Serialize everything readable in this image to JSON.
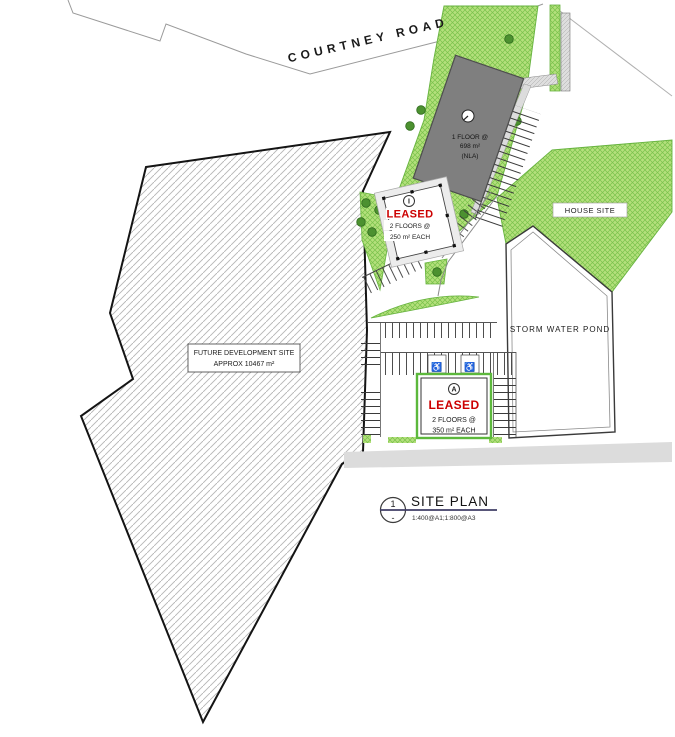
{
  "road": {
    "name": "COURTNEY ROAD"
  },
  "main_building": {
    "floors": "1 FLOOR @",
    "area": "698 m²",
    "nla": "(NLA)"
  },
  "leased_unit_i": {
    "marker": "I",
    "status": "LEASED",
    "floors": "2 FLOORS @",
    "area": "250 m² EACH"
  },
  "leased_unit_a": {
    "marker": "A",
    "status": "LEASED",
    "floors": "2 FLOORS @",
    "area": "350 m² EACH"
  },
  "house_site": {
    "label": "HOUSE SITE"
  },
  "storm_water_pond": {
    "label": "STORM WATER POND"
  },
  "future_development": {
    "line1": "FUTURE DEVELOPMENT SITE",
    "line2": "APPROX 10467 m²"
  },
  "title_block": {
    "detail_number": "1",
    "detail_sub": "-",
    "title": "SITE PLAN",
    "scale": "1:400@A1;1:800@A3"
  },
  "symbols": {
    "accessible_parking": "♿"
  },
  "colors": {
    "leased_text": "#cc0000",
    "landscape_green": "#b4e07c",
    "landscape_hatch": "#79c24b",
    "building_gray": "#7f7f7f",
    "title_underline": "#413e66",
    "road_strip_gray": "#dcdcdc"
  }
}
